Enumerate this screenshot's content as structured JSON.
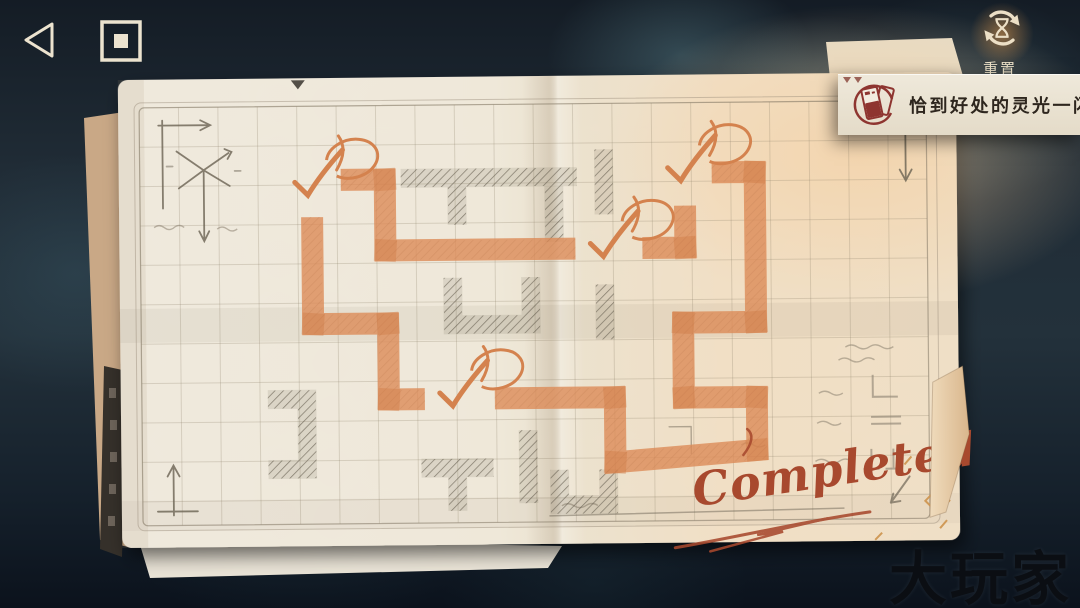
{
  "hud": {
    "reset_label": "重置",
    "banner_text": "恰到好处的灵光一闪",
    "watermark": "大玩家"
  },
  "paper": {
    "completed_label": "Completed"
  },
  "colors": {
    "accent_orange": "#dc8b58",
    "completed_red": "#a8492e",
    "banner_icon_red": "#8e3530",
    "hud_cream": "#ece3cf",
    "paper_cream": "#efe8da"
  },
  "puzzle": {
    "grid": {
      "x0": 141,
      "y0": 104,
      "x1": 928,
      "y1": 522,
      "cell": 39.4
    },
    "checkmarks": [
      [
        314,
        182
      ],
      [
        609,
        246
      ],
      [
        687,
        171
      ],
      [
        457,
        394
      ]
    ],
    "orange_segments": [
      "M342,178 L386,178 L386,249 L576,249",
      "M643,249 L686,249 L686,207",
      "M713,174 L756,174 L756,324 L683,324 L683,399 L756,399 L756,452 L614,463 L614,398 L494,398",
      "M424,398 L388,398 L388,322 L313,322 L313,215"
    ],
    "corner_patches": [
      [
        386,
        178
      ],
      [
        386,
        249
      ],
      [
        686,
        249
      ],
      [
        756,
        174
      ],
      [
        756,
        324
      ],
      [
        683,
        324
      ],
      [
        683,
        399
      ],
      [
        756,
        399
      ],
      [
        756,
        452
      ],
      [
        614,
        463
      ],
      [
        614,
        398
      ],
      [
        388,
        398
      ],
      [
        388,
        322
      ],
      [
        313,
        322
      ]
    ],
    "pencil_tiles": [
      "M402,177 L578,177",
      "M458,186 L458,224",
      "M555,186 L555,242",
      "M453,277 L453,324 L531,324 L531,277",
      "M267,397 L306,397 L306,467 L267,467",
      "M420,467 L492,467 M456,467 L456,510",
      "M527,430 L527,503",
      "M558,470 L558,505 L607,505 L607,470",
      "M605,150 L605,215",
      "M605,285 L605,340"
    ]
  }
}
